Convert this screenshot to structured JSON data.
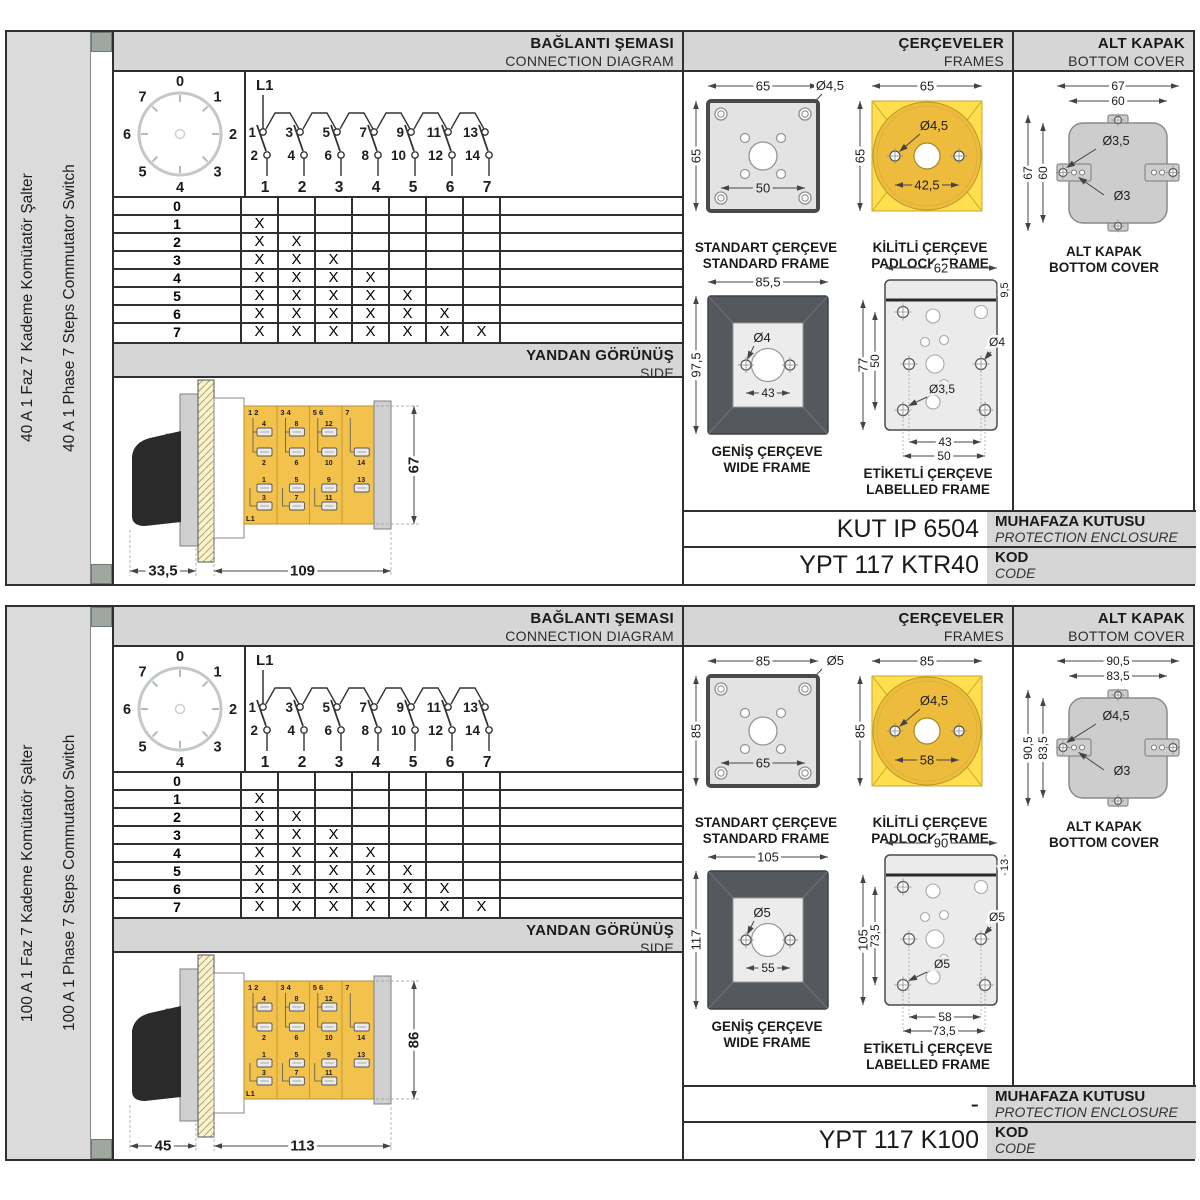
{
  "colors": {
    "panel_gray": "#d6d6d6",
    "sidebar_gray": "#dbdbdb",
    "corner_square": "#9ea7a0",
    "line_dark": "#2f2f2f",
    "switch_body_yellow": "#f2c24d",
    "padlock_square_yellow": "#ffdf4e",
    "padlock_circle_yellow": "#eebc3d",
    "wide_frame_dark": "#55585c",
    "frame_light_gray": "#e3e3e3",
    "cover_gray": "#cdcdcd"
  },
  "sections": [
    {
      "sidebar": {
        "title_tr": "40 A 1 Faz 7 Kademe Komütatör Şalter",
        "title_en": "40 A 1 Phase 7 Steps Commutator Switch"
      },
      "headers": {
        "connection_tr": "BAĞLANTI ŞEMASI",
        "connection_en": "CONNECTION DIAGRAM",
        "frames_tr": "ÇERÇEVELER",
        "frames_en": "FRAMES",
        "cover_tr": "ALT KAPAK",
        "cover_en": "BOTTOM COVER",
        "side_tr": "YANDAN GÖRÜNÜŞ",
        "side_en": "SIDE"
      },
      "dial": {
        "positions": [
          "0",
          "1",
          "2",
          "3",
          "4",
          "5",
          "6",
          "7"
        ]
      },
      "ladder": {
        "feed": "L1",
        "top_terminals": [
          "1",
          "3",
          "5",
          "7",
          "9",
          "11",
          "13"
        ],
        "bottom_terminals": [
          "2",
          "4",
          "6",
          "8",
          "10",
          "12",
          "14"
        ],
        "columns": [
          "1",
          "2",
          "3",
          "4",
          "5",
          "6",
          "7"
        ]
      },
      "step_table": {
        "steps": [
          "0",
          "1",
          "2",
          "3",
          "4",
          "5",
          "6",
          "7"
        ],
        "mark": "X",
        "marks_per_step": [
          0,
          1,
          2,
          3,
          4,
          5,
          6,
          7
        ]
      },
      "side_view": {
        "dim_depth": "33,5",
        "dim_length": "109",
        "dim_height": "67",
        "feed": "L1",
        "strip_top_labels": [
          "1  2",
          "3  4",
          "5  6",
          "7"
        ],
        "upper_terminals": [
          [
            "4",
            "2"
          ],
          [
            "8",
            "6"
          ],
          [
            "12",
            "10"
          ],
          [
            "14"
          ]
        ],
        "lower_terminals": [
          [
            "1",
            "3"
          ],
          [
            "5",
            "7"
          ],
          [
            "9",
            "11"
          ],
          [
            "13"
          ]
        ]
      },
      "frames": {
        "standard": {
          "caption_tr": "STANDART ÇERÇEVE",
          "caption_en": "STANDARD FRAME",
          "dim_width": "65",
          "dim_height": "65",
          "dim_hole": "Ø4,5",
          "dim_span": "50"
        },
        "padlock": {
          "caption_tr": "KİLİTLİ ÇERÇEVE",
          "caption_en": "PADLOCK FRAME",
          "dim_width": "65",
          "dim_height": "65",
          "dim_hole": "Ø4,5",
          "dim_span": "42,5"
        },
        "wide": {
          "caption_tr": "GENİŞ ÇERÇEVE",
          "caption_en": "WIDE FRAME",
          "dim_width": "85,5",
          "dim_height": "97,5",
          "dim_hole": "Ø4",
          "dim_span": "43"
        },
        "labelled": {
          "caption_tr": "ETİKETLİ ÇERÇEVE",
          "caption_en": "LABELLED FRAME",
          "dim_width": "62",
          "dim_strip": "9,5",
          "dim_height": "77",
          "dim_span_v": "50",
          "dim_hole_side": "Ø4",
          "dim_hole_corner": "Ø3,5",
          "dim_span_h1": "43",
          "dim_span_h2": "50"
        }
      },
      "cover": {
        "caption_tr": "ALT KAPAK",
        "caption_en": "BOTTOM COVER",
        "dim_w_outer": "67",
        "dim_w_inner": "60",
        "dim_h_outer": "67",
        "dim_h_inner": "60",
        "dim_hole_big": "Ø3,5",
        "dim_hole_small": "Ø3"
      },
      "codes": {
        "enclosure_value": "KUT IP 6504",
        "enclosure_label_tr": "MUHAFAZA KUTUSU",
        "enclosure_label_en": "PROTECTION ENCLOSURE",
        "code_value": "YPT 117 KTR40",
        "code_label_tr": "KOD",
        "code_label_en": "CODE"
      }
    },
    {
      "sidebar": {
        "title_tr": "100 A 1 Faz 7 Kademe Komütatör Şalter",
        "title_en": "100 A 1 Phase 7 Steps Commutator Switch"
      },
      "headers": {
        "connection_tr": "BAĞLANTI ŞEMASI",
        "connection_en": "CONNECTION DIAGRAM",
        "frames_tr": "ÇERÇEVELER",
        "frames_en": "FRAMES",
        "cover_tr": "ALT KAPAK",
        "cover_en": "BOTTOM COVER",
        "side_tr": "YANDAN GÖRÜNÜŞ",
        "side_en": "SIDE"
      },
      "dial": {
        "positions": [
          "0",
          "1",
          "2",
          "3",
          "4",
          "5",
          "6",
          "7"
        ]
      },
      "ladder": {
        "feed": "L1",
        "top_terminals": [
          "1",
          "3",
          "5",
          "7",
          "9",
          "11",
          "13"
        ],
        "bottom_terminals": [
          "2",
          "4",
          "6",
          "8",
          "10",
          "12",
          "14"
        ],
        "columns": [
          "1",
          "2",
          "3",
          "4",
          "5",
          "6",
          "7"
        ]
      },
      "step_table": {
        "steps": [
          "0",
          "1",
          "2",
          "3",
          "4",
          "5",
          "6",
          "7"
        ],
        "mark": "X",
        "marks_per_step": [
          0,
          1,
          2,
          3,
          4,
          5,
          6,
          7
        ]
      },
      "side_view": {
        "dim_depth": "45",
        "dim_length": "113",
        "dim_height": "86",
        "feed": "L1",
        "strip_top_labels": [
          "1  2",
          "3  4",
          "5  6",
          "7"
        ],
        "upper_terminals": [
          [
            "4",
            "2"
          ],
          [
            "8",
            "6"
          ],
          [
            "12",
            "10"
          ],
          [
            "14"
          ]
        ],
        "lower_terminals": [
          [
            "1",
            "3"
          ],
          [
            "5",
            "7"
          ],
          [
            "9",
            "11"
          ],
          [
            "13"
          ]
        ]
      },
      "frames": {
        "standard": {
          "caption_tr": "STANDART ÇERÇEVE",
          "caption_en": "STANDARD FRAME",
          "dim_width": "85",
          "dim_height": "85",
          "dim_hole": "Ø5",
          "dim_span": "65"
        },
        "padlock": {
          "caption_tr": "KİLİTLİ ÇERÇEVE",
          "caption_en": "PADLOCK FRAME",
          "dim_width": "85",
          "dim_height": "85",
          "dim_hole": "Ø4,5",
          "dim_span": "58"
        },
        "wide": {
          "caption_tr": "GENİŞ ÇERÇEVE",
          "caption_en": "WIDE FRAME",
          "dim_width": "105",
          "dim_height": "117",
          "dim_hole": "Ø5",
          "dim_span": "55"
        },
        "labelled": {
          "caption_tr": "ETİKETLİ ÇERÇEVE",
          "caption_en": "LABELLED FRAME",
          "dim_width": "90",
          "dim_strip": "13",
          "dim_height": "105",
          "dim_span_v": "73,5",
          "dim_hole_side": "Ø5",
          "dim_hole_corner": "Ø5",
          "dim_span_h1": "58",
          "dim_span_h2": "73,5"
        }
      },
      "cover": {
        "caption_tr": "ALT KAPAK",
        "caption_en": "BOTTOM COVER",
        "dim_w_outer": "90,5",
        "dim_w_inner": "83,5",
        "dim_h_outer": "90,5",
        "dim_h_inner": "83,5",
        "dim_hole_big": "Ø4,5",
        "dim_hole_small": "Ø3"
      },
      "codes": {
        "enclosure_value": "-",
        "enclosure_label_tr": "MUHAFAZA KUTUSU",
        "enclosure_label_en": "PROTECTION ENCLOSURE",
        "code_value": "YPT 117 K100",
        "code_label_tr": "KOD",
        "code_label_en": "CODE"
      }
    }
  ]
}
